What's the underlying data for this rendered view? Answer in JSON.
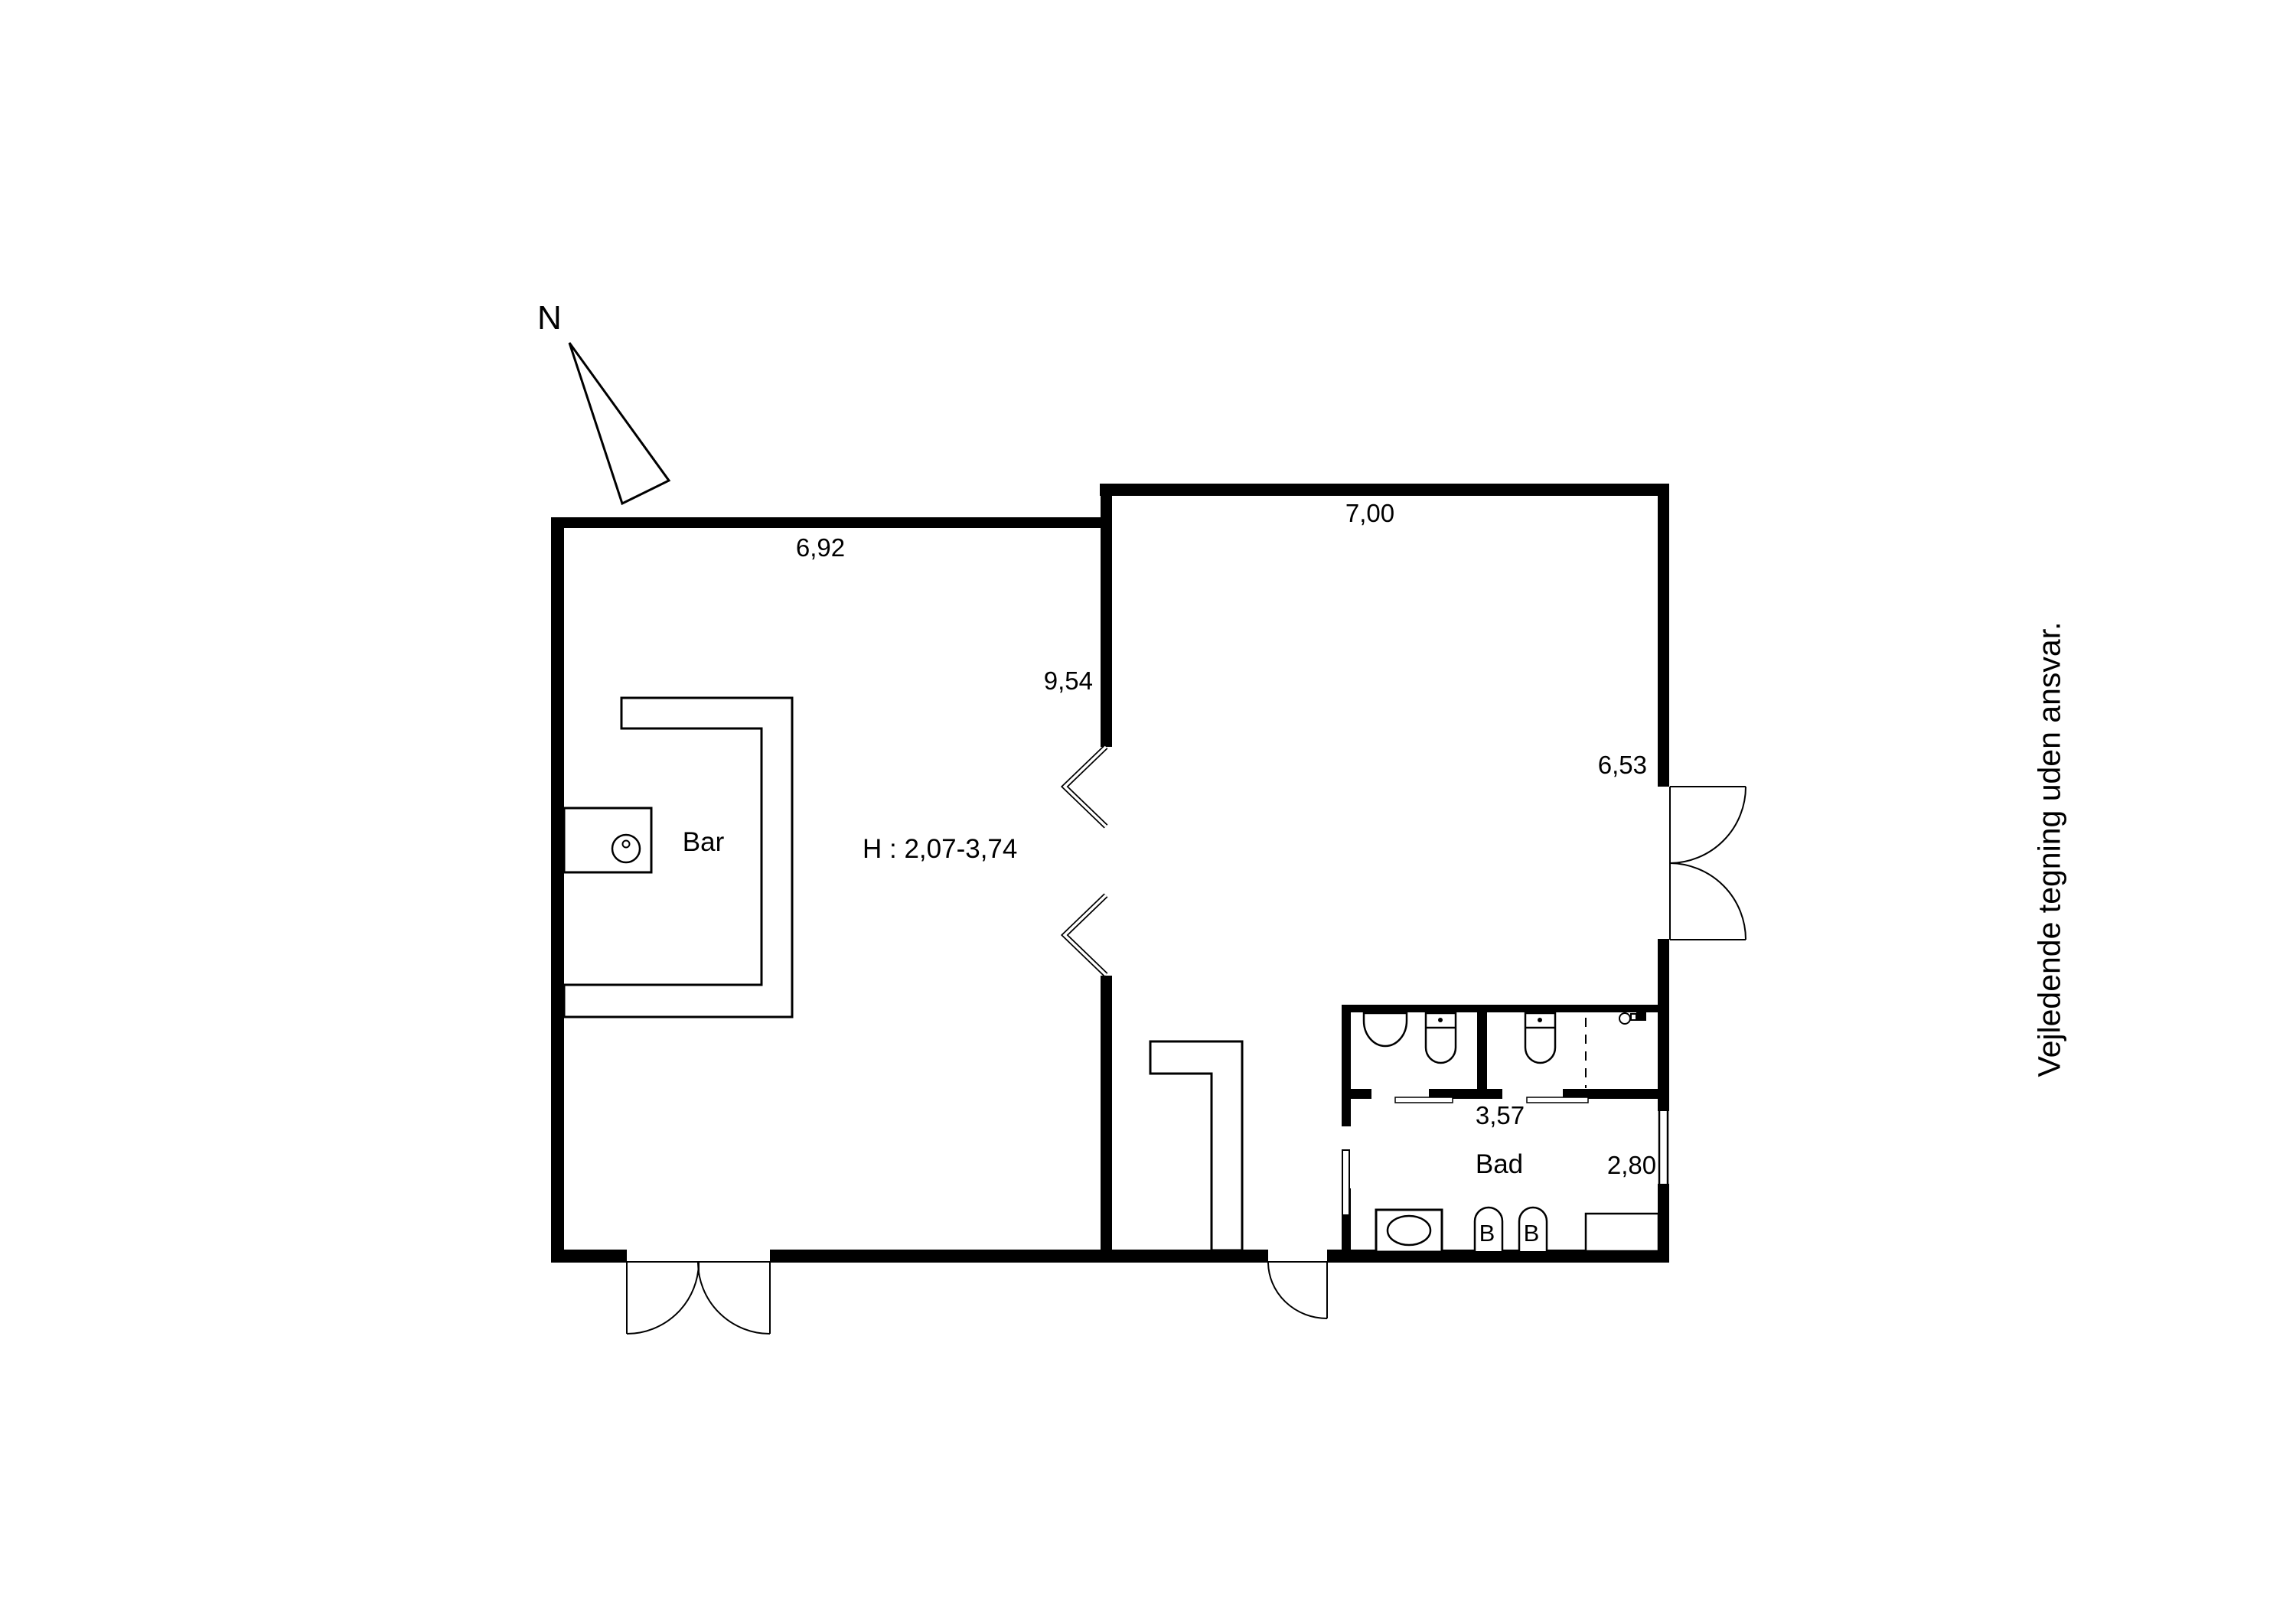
{
  "compass": {
    "north_label": "N"
  },
  "dimensions": {
    "hall_width": "6,92",
    "main_width": "7,00",
    "hall_depth": "9,54",
    "main_depth": "6,53",
    "wc_width": "3,57",
    "bad_width": "2,80",
    "ceiling_height": "H : 2,07-3,74"
  },
  "rooms": {
    "bar": "Bar",
    "bad": "Bad"
  },
  "fixtures": {
    "basin_left_label": "B",
    "basin_right_label": "B"
  },
  "disclaimer": "Vejledende tegning uden ansvar.",
  "colors": {
    "wall": "#000000",
    "line": "#000000",
    "background": "#ffffff"
  }
}
